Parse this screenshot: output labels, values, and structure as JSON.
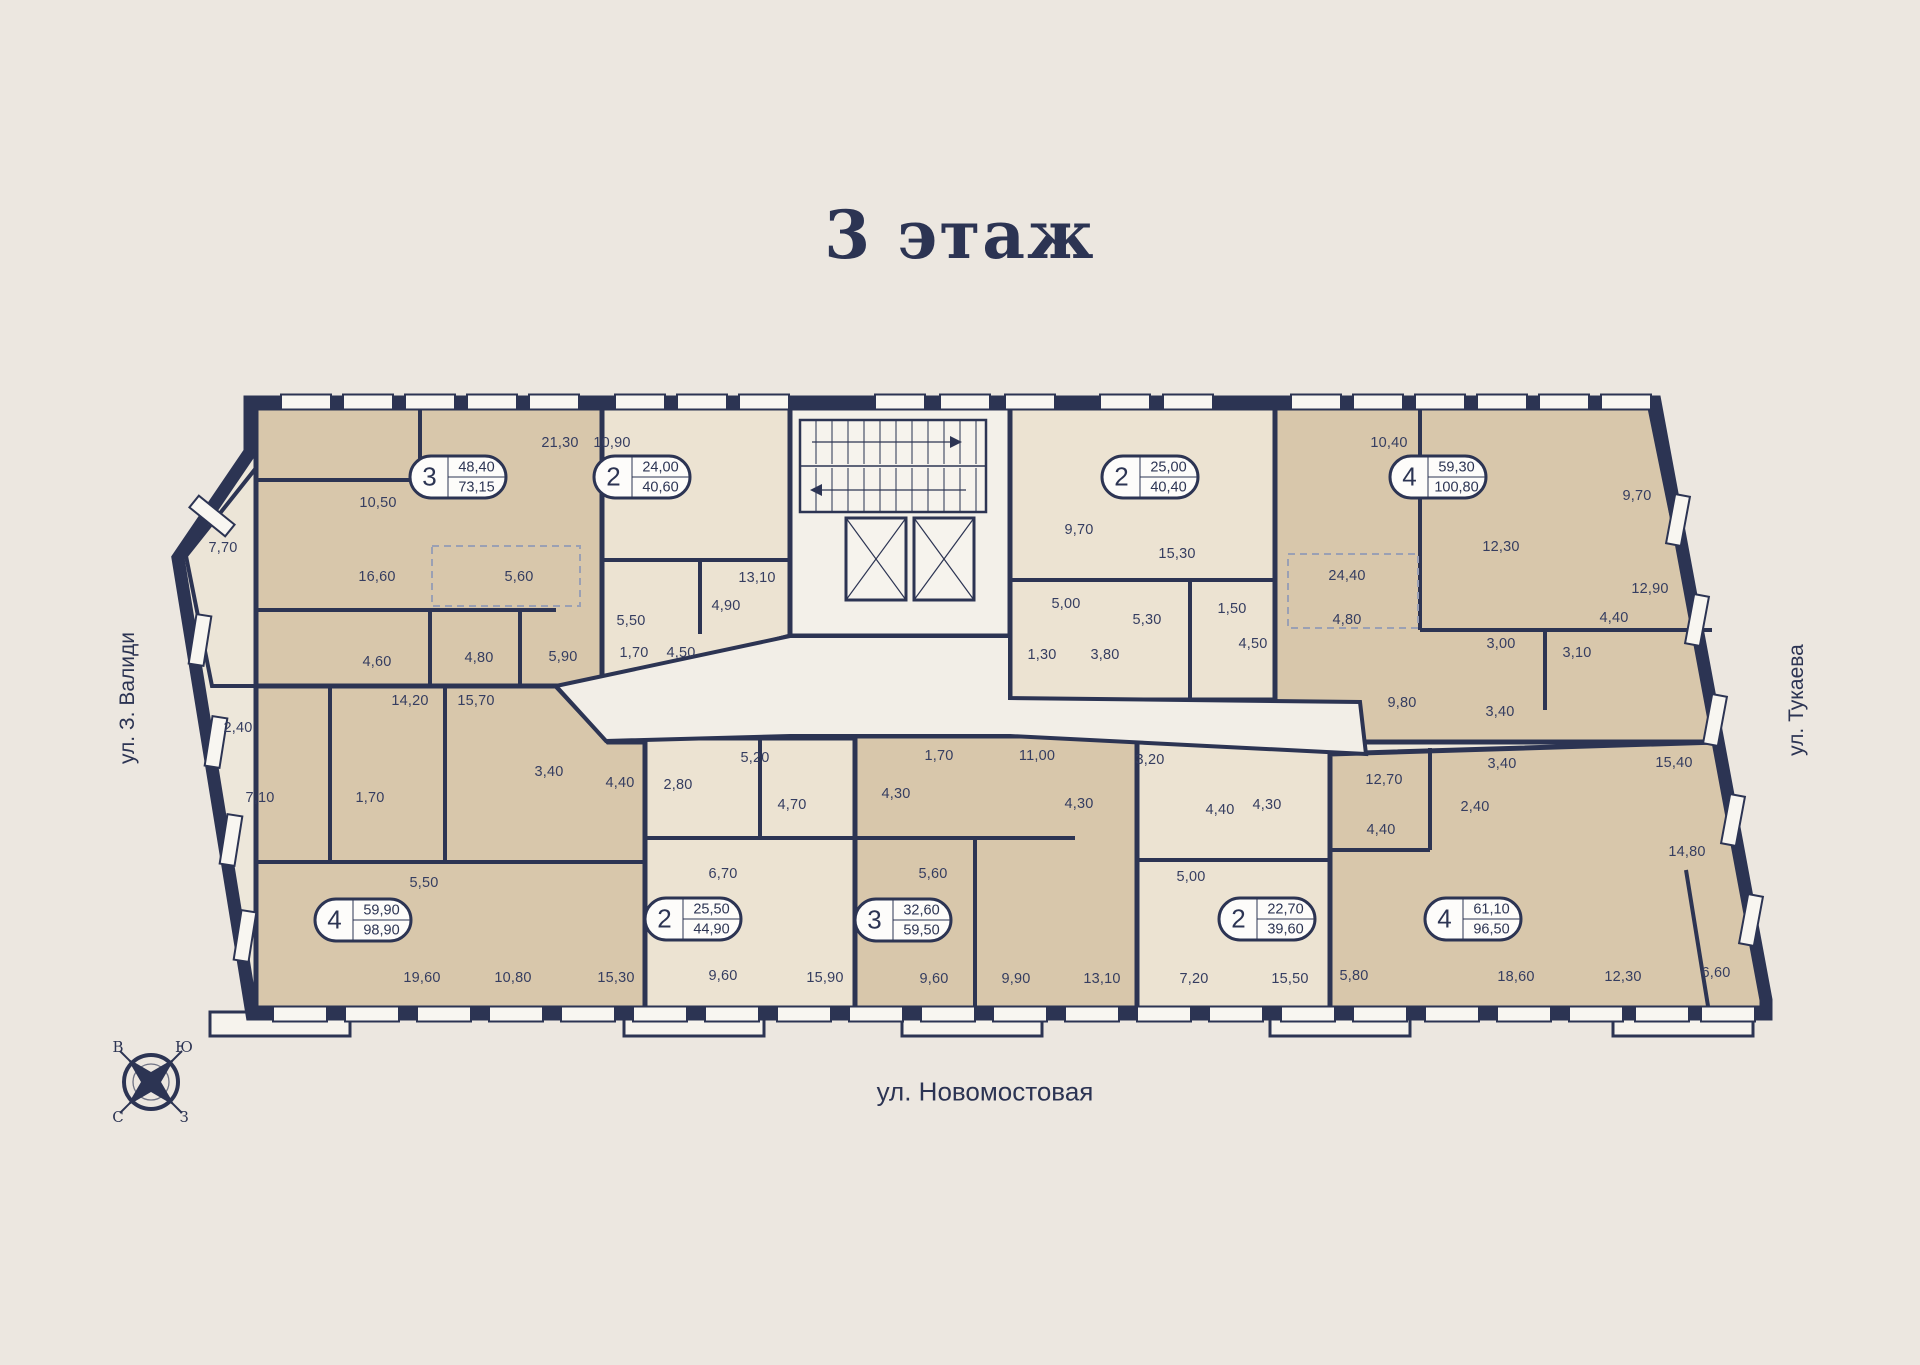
{
  "title": "3 этаж",
  "streets": {
    "left": "ул. З. Валиди",
    "right": "ул. Тукаева",
    "bottom": "ул. Новомостовая"
  },
  "compass": {
    "top_left": "В",
    "top_right": "Ю",
    "bottom_left": "С",
    "bottom_right": "З"
  },
  "colors": {
    "background": "#ECE7E0",
    "wall": "#2C3453",
    "room_tan": "#D8C7AB",
    "room_cream": "#ECE3D2",
    "common_area": "#F2EEE7",
    "badge_bg": "#FDFCFA",
    "dim_text": "#353D60"
  },
  "apartments": [
    {
      "rooms": "3",
      "living_area": "48,40",
      "total_area": "73,15",
      "x": 458,
      "y": 477
    },
    {
      "rooms": "2",
      "living_area": "24,00",
      "total_area": "40,60",
      "x": 642,
      "y": 477
    },
    {
      "rooms": "2",
      "living_area": "25,00",
      "total_area": "40,40",
      "x": 1150,
      "y": 477
    },
    {
      "rooms": "4",
      "living_area": "59,30",
      "total_area": "100,80",
      "x": 1438,
      "y": 477
    },
    {
      "rooms": "4",
      "living_area": "59,90",
      "total_area": "98,90",
      "x": 363,
      "y": 920
    },
    {
      "rooms": "2",
      "living_area": "25,50",
      "total_area": "44,90",
      "x": 693,
      "y": 919
    },
    {
      "rooms": "3",
      "living_area": "32,60",
      "total_area": "59,50",
      "x": 903,
      "y": 920
    },
    {
      "rooms": "2",
      "living_area": "22,70",
      "total_area": "39,60",
      "x": 1267,
      "y": 919
    },
    {
      "rooms": "4",
      "living_area": "61,10",
      "total_area": "96,50",
      "x": 1473,
      "y": 919
    }
  ],
  "room_dimensions": [
    {
      "v": "21,30",
      "x": 560,
      "y": 443
    },
    {
      "v": "10,90",
      "x": 612,
      "y": 443
    },
    {
      "v": "10,50",
      "x": 378,
      "y": 503
    },
    {
      "v": "7,70",
      "x": 223,
      "y": 548
    },
    {
      "v": "16,60",
      "x": 377,
      "y": 577
    },
    {
      "v": "5,60",
      "x": 519,
      "y": 577
    },
    {
      "v": "4,60",
      "x": 377,
      "y": 662
    },
    {
      "v": "4,80",
      "x": 479,
      "y": 658
    },
    {
      "v": "5,90",
      "x": 563,
      "y": 657
    },
    {
      "v": "13,10",
      "x": 757,
      "y": 578
    },
    {
      "v": "4,90",
      "x": 726,
      "y": 606
    },
    {
      "v": "5,50",
      "x": 631,
      "y": 621
    },
    {
      "v": "1,70",
      "x": 634,
      "y": 653
    },
    {
      "v": "4,50",
      "x": 681,
      "y": 653
    },
    {
      "v": "9,70",
      "x": 1079,
      "y": 530
    },
    {
      "v": "15,30",
      "x": 1177,
      "y": 554
    },
    {
      "v": "5,00",
      "x": 1066,
      "y": 604
    },
    {
      "v": "5,30",
      "x": 1147,
      "y": 620
    },
    {
      "v": "1,50",
      "x": 1232,
      "y": 609
    },
    {
      "v": "4,50",
      "x": 1253,
      "y": 644
    },
    {
      "v": "24,40",
      "x": 1347,
      "y": 576
    },
    {
      "v": "4,80",
      "x": 1347,
      "y": 620
    },
    {
      "v": "1,30",
      "x": 1042,
      "y": 655
    },
    {
      "v": "3,80",
      "x": 1105,
      "y": 655
    },
    {
      "v": "10,40",
      "x": 1389,
      "y": 443
    },
    {
      "v": "9,70",
      "x": 1637,
      "y": 496
    },
    {
      "v": "12,30",
      "x": 1501,
      "y": 547
    },
    {
      "v": "12,90",
      "x": 1650,
      "y": 589
    },
    {
      "v": "4,40",
      "x": 1614,
      "y": 618
    },
    {
      "v": "3,00",
      "x": 1501,
      "y": 644
    },
    {
      "v": "3,10",
      "x": 1577,
      "y": 653
    },
    {
      "v": "9,80",
      "x": 1402,
      "y": 703
    },
    {
      "v": "3,40",
      "x": 1500,
      "y": 712
    },
    {
      "v": "2,40",
      "x": 238,
      "y": 728
    },
    {
      "v": "14,20",
      "x": 410,
      "y": 701
    },
    {
      "v": "15,70",
      "x": 476,
      "y": 701
    },
    {
      "v": "7,10",
      "x": 260,
      "y": 798
    },
    {
      "v": "1,70",
      "x": 370,
      "y": 798
    },
    {
      "v": "3,40",
      "x": 549,
      "y": 772
    },
    {
      "v": "4,40",
      "x": 620,
      "y": 783
    },
    {
      "v": "2,80",
      "x": 678,
      "y": 785
    },
    {
      "v": "5,20",
      "x": 755,
      "y": 758
    },
    {
      "v": "4,70",
      "x": 792,
      "y": 805
    },
    {
      "v": "1,70",
      "x": 939,
      "y": 756
    },
    {
      "v": "11,00",
      "x": 1037,
      "y": 756
    },
    {
      "v": "3,20",
      "x": 1150,
      "y": 760
    },
    {
      "v": "4,30",
      "x": 896,
      "y": 794
    },
    {
      "v": "4,30",
      "x": 1079,
      "y": 804
    },
    {
      "v": "4,40",
      "x": 1220,
      "y": 810
    },
    {
      "v": "4,30",
      "x": 1267,
      "y": 805
    },
    {
      "v": "12,70",
      "x": 1384,
      "y": 780
    },
    {
      "v": "4,40",
      "x": 1381,
      "y": 830
    },
    {
      "v": "3,40",
      "x": 1502,
      "y": 764
    },
    {
      "v": "15,40",
      "x": 1674,
      "y": 763
    },
    {
      "v": "2,40",
      "x": 1475,
      "y": 807
    },
    {
      "v": "14,80",
      "x": 1687,
      "y": 852
    },
    {
      "v": "5,50",
      "x": 424,
      "y": 883
    },
    {
      "v": "6,70",
      "x": 723,
      "y": 874
    },
    {
      "v": "5,60",
      "x": 933,
      "y": 874
    },
    {
      "v": "5,00",
      "x": 1191,
      "y": 877
    },
    {
      "v": "19,60",
      "x": 422,
      "y": 978
    },
    {
      "v": "10,80",
      "x": 513,
      "y": 978
    },
    {
      "v": "15,30",
      "x": 616,
      "y": 978
    },
    {
      "v": "9,60",
      "x": 723,
      "y": 976
    },
    {
      "v": "15,90",
      "x": 825,
      "y": 978
    },
    {
      "v": "9,60",
      "x": 934,
      "y": 979
    },
    {
      "v": "9,90",
      "x": 1016,
      "y": 979
    },
    {
      "v": "13,10",
      "x": 1102,
      "y": 979
    },
    {
      "v": "7,20",
      "x": 1194,
      "y": 979
    },
    {
      "v": "15,50",
      "x": 1290,
      "y": 979
    },
    {
      "v": "5,80",
      "x": 1354,
      "y": 976
    },
    {
      "v": "18,60",
      "x": 1516,
      "y": 977
    },
    {
      "v": "12,30",
      "x": 1623,
      "y": 977
    },
    {
      "v": "6,60",
      "x": 1716,
      "y": 973
    }
  ]
}
